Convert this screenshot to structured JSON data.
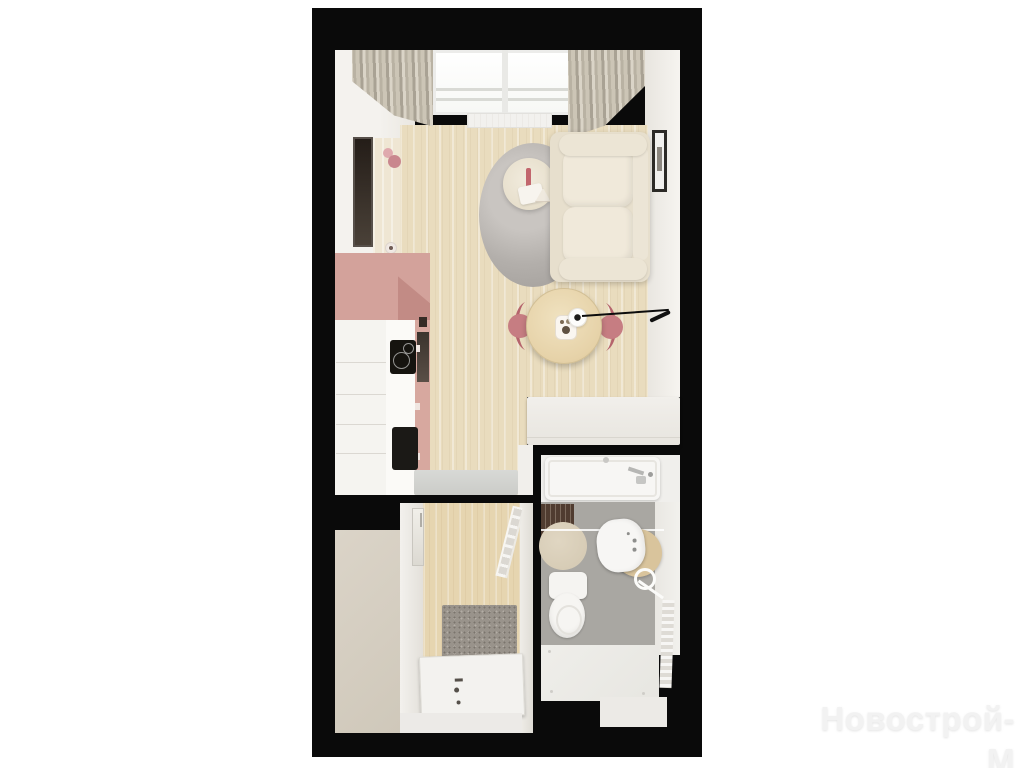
{
  "watermark": {
    "text": "Новострой-М"
  },
  "floor_plan": {
    "view": "top-down 3D render of a studio apartment",
    "rooms": [
      {
        "name": "living-room-with-kitchen",
        "features": [
          "window-with-curtains",
          "radiator",
          "wall-mirror",
          "pink-wall-sconce",
          "gray-round-rug",
          "coffee-table",
          "beige-sofa",
          "wall-picture",
          "pink-kitchen-cabinets",
          "white-base-cabinets",
          "induction-hob",
          "black-sink",
          "round-dining-table",
          "two-rose-chairs",
          "pendant-light",
          "gray-mat",
          "white-wardrobe"
        ]
      },
      {
        "name": "hallway",
        "features": [
          "built-in-wardrobe",
          "wall-mirror",
          "drying-rack",
          "speckled-doormat",
          "entrance-door"
        ]
      },
      {
        "name": "bathroom",
        "features": [
          "bathtub",
          "chrome-faucet",
          "wooden-slat-mat",
          "round-rug",
          "washbasin",
          "wooden-pedestal",
          "towel-ring",
          "toilet",
          "towel-radiator",
          "glass-screen"
        ]
      }
    ],
    "annotation_arrow": {
      "type": "leader-line",
      "points_to": "pendant-light-over-dining-table"
    }
  },
  "palette": {
    "background": "#ffffff",
    "walls_black": "#0a0a0a",
    "wood_floor": "#e9dcbe",
    "accent_pink": "#d3a29b",
    "chair_rose": "#c67d82",
    "bath_floor_gray": "#a9a7a2",
    "watermark_color": "#f2f2f2"
  }
}
